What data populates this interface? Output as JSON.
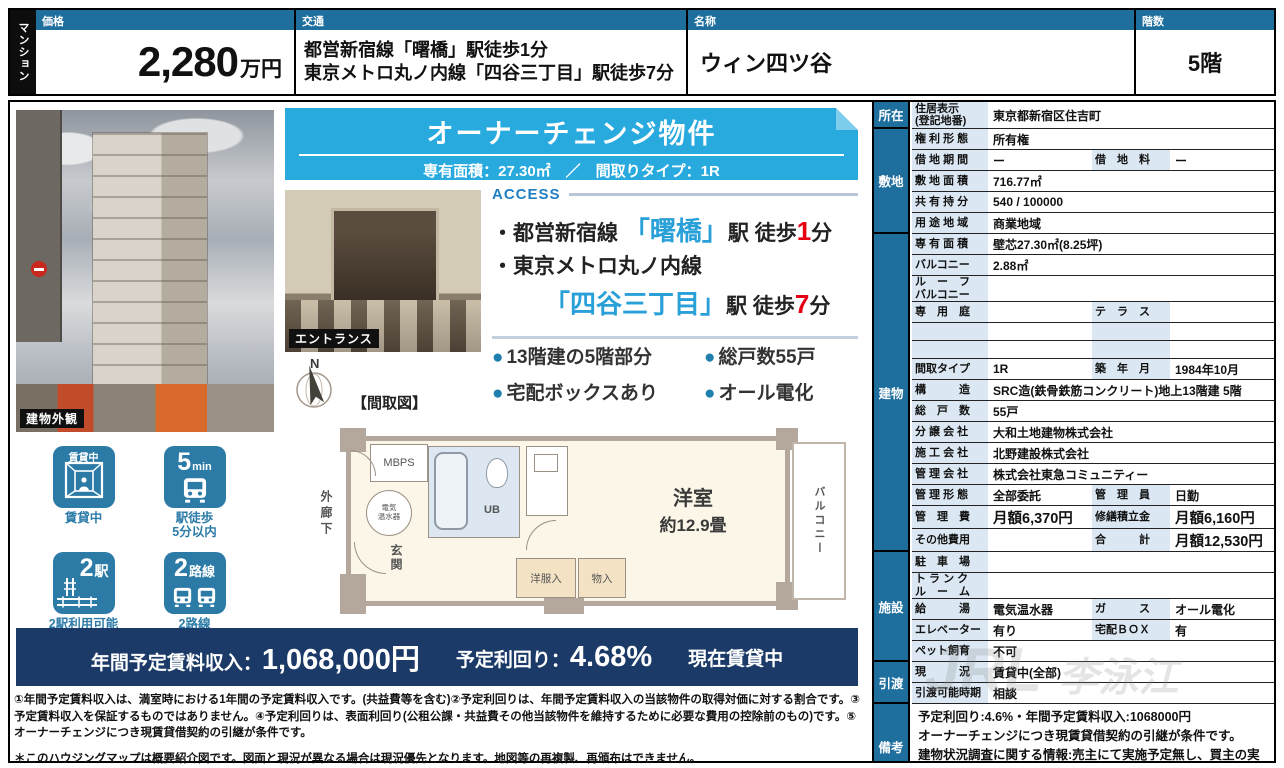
{
  "colors": {
    "accent_blue": "#1e6e9e",
    "banner_cyan": "#29aade",
    "station_cyan": "#2aa0d8",
    "alert_red": "#e60012",
    "navy_bar": "#1b3a68",
    "icon_blue": "#2c7ba7",
    "label_cell_bg": "#dbe7f2"
  },
  "header": {
    "category": "マンション",
    "price": {
      "label": "価格",
      "value": "2,280",
      "unit": "万円"
    },
    "transport": {
      "label": "交通",
      "line1": "都営新宿線「曙橋」駅徒歩1分",
      "line2": "東京メトロ丸ノ内線「四谷三丁目」駅徒歩7分"
    },
    "name": {
      "label": "名称",
      "value": "ウィン四ツ谷"
    },
    "floor": {
      "label": "階数",
      "value": "5階"
    }
  },
  "banner": {
    "title": "オーナーチェンジ物件",
    "subtitle": "専有面積：27.30㎡　／　間取りタイプ：1R"
  },
  "photos": {
    "exterior_caption": "建物外観",
    "entrance_caption": "エントランス"
  },
  "access": {
    "heading": "ACCESS",
    "line1": {
      "prefix": "・都営新宿線 ",
      "station": "「曙橋」",
      "mid": "駅 徒歩",
      "minutes": "1",
      "suffix": "分"
    },
    "line2": "・東京メトロ丸ノ内線",
    "line3": {
      "station": "「四谷三丁目」",
      "mid": "駅 徒歩",
      "minutes": "7",
      "suffix": "分"
    }
  },
  "features": [
    "13階建の5階部分",
    "総戸数55戸",
    "宅配ボックスあり",
    "オール電化"
  ],
  "badges": [
    {
      "badge": "賃貸中",
      "caption": "賃貸中"
    },
    {
      "num": "5",
      "unit": "min",
      "caption": "駅徒歩\n5分以内"
    },
    {
      "num": "2",
      "unit": "駅",
      "caption": "2駅利用可能"
    },
    {
      "num": "2",
      "unit": "路線",
      "caption": "2路線\n利用可能"
    }
  ],
  "floorplan": {
    "heading": "【間取図】",
    "compass": "N",
    "corridor": "外廊下",
    "mbps": "MBPS",
    "water_heater": "電気\n温水器",
    "ub": "UB",
    "genkan": "玄関",
    "room": "洋室",
    "room_size": "約12.9畳",
    "closet1": "洋服入",
    "closet2": "物入",
    "balcony": "バルコニー"
  },
  "income_bar": {
    "label1": "年間予定賃料収入：",
    "value1": "1,068,000円",
    "label2": "予定利回り：",
    "value2": "4.68%",
    "status": "現在賃貸中"
  },
  "fine_print": {
    "p1": "①年間予定賃料収入は、満室時における1年間の予定賃料収入です。(共益費等を含む)②予定利回りは、年間予定賃料収入の当該物件の取得対価に対する割合です。③予定賃料収入を保証するものではありません。④予定利回りは、表面利回り(公租公課・共益費その他当該物件を維持するために必要な費用の控除前のもの)です。⑤オーナーチェンジにつき現賃貸借契約の引継が条件です。",
    "p2": "＊このハウジングマップは概要紹介図です。図面と現況が異なる場合は現況優先となります。地図等の再複製、再頒布はできません。"
  },
  "watermark": {
    "big": "JRL",
    "small": "李泳江"
  },
  "property_table": {
    "groups": [
      {
        "label": "所在",
        "from": 0,
        "to": 0
      },
      {
        "label": "敷地",
        "from": 1,
        "to": 5
      },
      {
        "label": "建物",
        "from": 6,
        "to": 20
      },
      {
        "label": "施設",
        "from": 21,
        "to": 25
      },
      {
        "label": "引渡",
        "from": 26,
        "to": 27
      },
      {
        "label": "備考",
        "from": 28,
        "to": 28
      }
    ],
    "rows": [
      {
        "l": "住居表示\n(登記地番)",
        "v": "東京都新宿区住吉町",
        "h": 26
      },
      {
        "l": "権 利 形 態",
        "v": "所有権"
      },
      {
        "l": "借 地 期 間",
        "v": "ー",
        "l2": "借　地　料",
        "v2": "ー",
        "type": "split"
      },
      {
        "l": "敷 地 面 積",
        "v": "716.77㎡"
      },
      {
        "l": "共 有 持 分",
        "v": "540 / 100000"
      },
      {
        "l": "用 途 地 域",
        "v": "商業地域"
      },
      {
        "l": "専 有 面 積",
        "v": "壁芯27.30㎡(8.25坪)"
      },
      {
        "l": "バルコニー",
        "v": "2.88㎡"
      },
      {
        "l": "ル　ー　フ\nバルコニー",
        "v": "",
        "h": 25
      },
      {
        "l": "専　用　庭",
        "v": "",
        "l2": "テ　ラ　ス",
        "v2": "",
        "type": "split"
      },
      {
        "l": "",
        "v": "",
        "l2": "",
        "v2": "",
        "type": "split",
        "h": 17
      },
      {
        "l": "",
        "v": "",
        "l2": "",
        "v2": "",
        "type": "split",
        "h": 17
      },
      {
        "l": "間取タイプ",
        "v": "1R",
        "l2": "築　年　月",
        "v2": "1984年10月",
        "type": "split"
      },
      {
        "l": "構　　　造",
        "v": "SRC造(鉄骨鉄筋コンクリート)地上13階建 5階"
      },
      {
        "l": "総　戸　数",
        "v": "55戸"
      },
      {
        "l": "分 譲 会 社",
        "v": "大和土地建物株式会社"
      },
      {
        "l": "施 工 会 社",
        "v": "北野建設株式会社"
      },
      {
        "l": "管 理 会 社",
        "v": "株式会社東急コミュニティー"
      },
      {
        "l": "管 理 形 態",
        "v": "全部委託",
        "l2": "管　理　員",
        "v2": "日勤",
        "type": "split"
      },
      {
        "l": "管　理　費",
        "v": "月額6,370円",
        "l2": "修繕積立金",
        "v2": "月額6,160円",
        "type": "split",
        "big": true,
        "h": 22
      },
      {
        "l": "その他費用",
        "v": "",
        "l2": "合　　　計",
        "v2": "月額12,530円",
        "type": "split",
        "big": true,
        "h": 22
      },
      {
        "l": "駐　車　場",
        "v": ""
      },
      {
        "l": "ト ラ ン ク\nル　ー　ム",
        "v": "",
        "h": 25
      },
      {
        "l": "給　　　湯",
        "v": "電気温水器",
        "l2": "ガ　　　ス",
        "v2": "オール電化",
        "type": "split"
      },
      {
        "l": "エレベーター",
        "v": "有り",
        "l2": "宅配ＢＯＸ",
        "v2": "有",
        "type": "split"
      },
      {
        "l": "ペット飼育",
        "v": "不可"
      },
      {
        "l": "現　　　況",
        "v": "賃貸中(全部)"
      },
      {
        "l": "引渡可能時期",
        "v": "相談"
      },
      {
        "type": "remarks",
        "v": "予定利回り:4.6%・年間予定賃料収入:1068000円\nオーナーチェンジにつき現賃貸借契約の引継が条件です。\n建物状況調査に関する情報:売主にて実施予定無し、買主の実施不可",
        "h": 86
      }
    ]
  }
}
